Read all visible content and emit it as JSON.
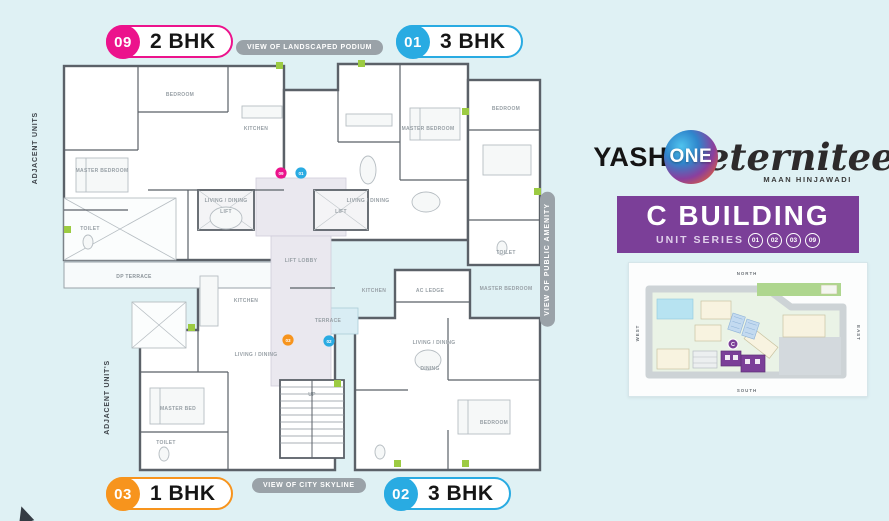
{
  "colors": {
    "pink": "#ec138c",
    "blue": "#29abe2",
    "orange": "#f7941d",
    "purple": "#7b3f98",
    "gray_pill": "#9aa2a8",
    "wall": "#5b6168",
    "background": "#dff1f4",
    "plant_green": "#9ccb42"
  },
  "legend": {
    "top_left": {
      "num": "09",
      "label": "2 BHK"
    },
    "top_right": {
      "num": "01",
      "label": "3 BHK"
    },
    "bottom_left": {
      "num": "03",
      "label": "1 BHK"
    },
    "bottom_right": {
      "num": "02",
      "label": "3 BHK"
    }
  },
  "views": {
    "podium": "VIEW OF LANDSCAPED PODIUM",
    "skyline": "VIEW OF CITY SKYLINE",
    "amenity": "VIEW OF PUBLIC AMENITY"
  },
  "adjacent": {
    "upper": "ADJACENT UNITS",
    "lower": "ADJACENT UNIT'S"
  },
  "plan": {
    "markers": [
      "09",
      "01",
      "03",
      "02"
    ],
    "rooms": [
      "MASTER BEDROOM",
      "BEDROOM",
      "KITCHEN",
      "LIVING / DINING",
      "TOILET",
      "DP TERRACE",
      "MASTER BEDROOM",
      "LIVING / DINING",
      "BEDROOM",
      "TOILET",
      "LIFT",
      "LIFT",
      "LIFT LOBBY",
      "KITCHEN",
      "LIVING / DINING",
      "MASTER BED",
      "TOILET",
      "LIVING / DINING",
      "MASTER BEDROOM",
      "BEDROOM",
      "AC LEDGE",
      "UP",
      "DINING",
      "TERRACE",
      "KITCHEN"
    ]
  },
  "brand": {
    "yash": "YASH",
    "one": "ONE",
    "name": "eternitee",
    "tagline": "MAAN HINJAWADI"
  },
  "banner": {
    "title": "C BUILDING",
    "subtitle": "UNIT SERIES",
    "series": [
      "01",
      "02",
      "03",
      "09"
    ]
  },
  "sitemap": {
    "directions": {
      "north": "NORTH",
      "south": "SOUTH",
      "east": "EAST",
      "west": "WEST"
    },
    "highlight": "C"
  }
}
